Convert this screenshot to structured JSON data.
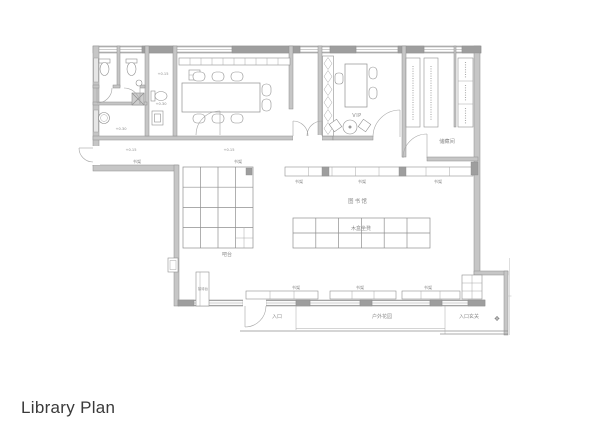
{
  "title": "Library Plan",
  "colors": {
    "background": "#ffffff",
    "wall": "#c6c6c6",
    "wall_pier": "#9e9e9e",
    "line": "#8f8f8f",
    "label_text": "#8a8a8a",
    "title_text": "#3a3a3a"
  },
  "rooms": {
    "vip": "VIP",
    "storage": "储藏间",
    "hall": "图书馆",
    "box_seats": "木盒坐凳",
    "bar": "吧台",
    "reception": "接待台",
    "entrance": "入口",
    "garden": "户外花园",
    "foyer": "入口玄关"
  },
  "shelf_label": "书架",
  "levels": {
    "p030": "+0.30",
    "p015": "+0.15"
  },
  "ornament": "❖"
}
